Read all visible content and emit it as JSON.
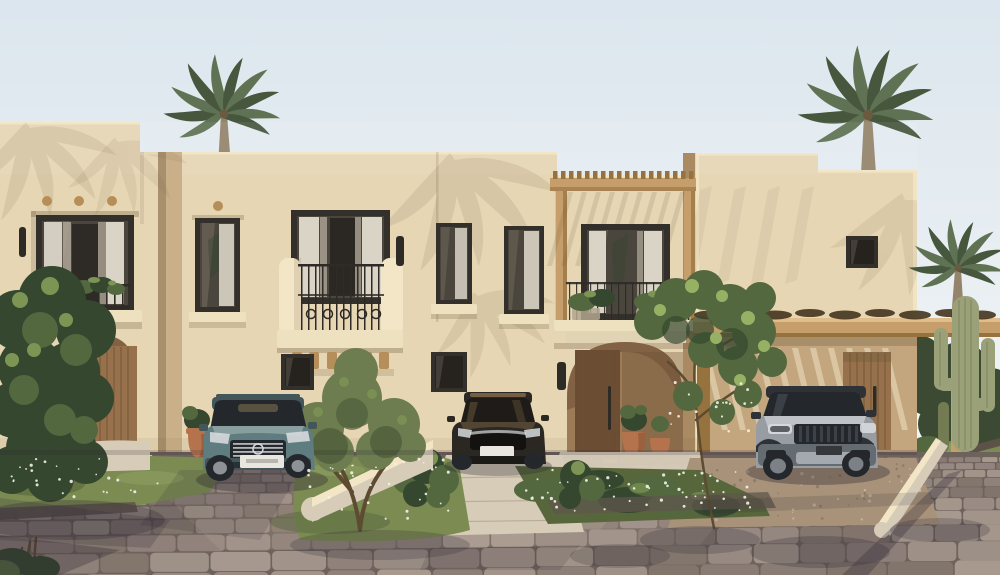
{
  "scene": {
    "description": "Sunny 3D architectural render of a row of sand-colored stucco townhouses with black-framed windows, Juliet balconies, wooden pergolas, arched entrances, palm trees, a saguaro cactus, three parked cars and a cobblestone street in the foreground.",
    "time_of_day": "bright daylight, warm low sun from the left casting palm-frond shadows on the facade",
    "buildings": [
      {
        "name": "townhouse-1",
        "features": [
          "stepped parapet",
          "recessed upper window with Juliet balcony and plants",
          "three round timber dots",
          "two wall sconces",
          "arched entrance alcove with plank wood door",
          "low curved garden wall"
        ]
      },
      {
        "name": "townhouse-2",
        "features": [
          "large upper window with ornamental iron balcony on timber corbels",
          "narrow upper window",
          "two small dark ground-floor windows",
          "wall sconce",
          "driveway with parked sedan"
        ]
      },
      {
        "name": "townhouse-3",
        "features": [
          "timber pergola over balcony with planter boxes",
          "large curtained window",
          "moulded cornice",
          "wide arched entrance with plank door and long handle",
          "terracotta pots with topiary",
          "wall sconce"
        ]
      },
      {
        "name": "townhouse-4",
        "features": [
          "small square window",
          "timber carport pergola with vine-covered beam",
          "slatted light stripes on shaded wall",
          "plank wood side door",
          "parked SUV"
        ]
      }
    ],
    "vehicles": [
      {
        "name": "teal-estate-car",
        "type": "station wagon with roof rails",
        "color": "teal grey",
        "position": "left driveway"
      },
      {
        "name": "dark-sedan",
        "type": "compact sedan",
        "color": "dark bronze black",
        "position": "middle driveway"
      },
      {
        "name": "grey-suv",
        "type": "luxury SUV",
        "color": "silver grey",
        "position": "under right carport"
      }
    ],
    "vegetation": [
      "palm tree behind left parapet",
      "palm tree behind right parapet",
      "small palm at far right",
      "large dark green shrub at far left",
      "olive tree on central grass mound",
      "climbing tree at carport corner",
      "white-flowering ground cover beds",
      "round clipped bushes",
      "saguaro cactus",
      "balcony plants"
    ],
    "street": {
      "surface": "cobblestone setts in tilted rows",
      "extras": [
        "concrete driveway apron",
        "gravel carport drive",
        "stone kerbs",
        "long diagonal post shadow",
        "dappled tree shadows"
      ]
    }
  },
  "palette": {
    "sky_top": "#dce6ee",
    "sky_bottom": "#f7f8f7",
    "wall": "#e6d6b4",
    "wall_light": "#f2e6c6",
    "wall_shade": "#c3a67e",
    "wall_return": "#a98a62",
    "shadow_warm": "#6b5638",
    "shadow_cool": "#2a2432",
    "alcove": "#9c7b57",
    "alcove_dark": "#6d4f35",
    "door_wood": "#96714b",
    "door_wood_dark": "#6b4d33",
    "door_wood_lit": "#b08a5c",
    "frame_dark": "#332f2a",
    "glass": "#4a453d",
    "glass_dark": "#26231f",
    "glass_light": "#7b7264",
    "curtain": "#dad4c7",
    "curtain_shade": "#b4ac9d",
    "iron": "#2e2a26",
    "wood": "#c59e6b",
    "wood_dark": "#96723f",
    "wood_light": "#e0bd8a",
    "vine_dark": "#44351f",
    "ledge": "#eee1bf",
    "corbel": "#b68e5a",
    "branch": "#5d4b32",
    "green_dark": "#35472f",
    "green_mid": "#53683f",
    "green_light": "#7c9454",
    "green_bright": "#97b164",
    "olive": "#6d7d50",
    "olive_dark": "#4f5e3a",
    "palm_green": "#5f7354",
    "palm_dark": "#46573e",
    "palm_trunk": "#94846c",
    "cactus": "#9aa077",
    "cactus_dark": "#737b52",
    "grass": "#7b8b52",
    "grass_light": "#9cab68",
    "grass_shade": "#57673b",
    "flower": "#f3f2e8",
    "terracotta": "#b5734d",
    "terracotta_dark": "#8a5434",
    "concrete": "#d6ccb8",
    "concrete_shade": "#b2a68e",
    "gravel": "#a8937a",
    "gravel_dark": "#7f6d57",
    "street_base": "#6e625c",
    "cobbles": [
      "#9b8d86",
      "#92847d",
      "#a3958c",
      "#8a7c75",
      "#a89a8f",
      "#84776e"
    ],
    "tree_line": "#3c4a34",
    "teal_body": "#5f7c80",
    "teal_dark": "#43575b",
    "teal_light": "#95a9aa",
    "sedan_body": "#2b2824",
    "sedan_warm": "#82694a",
    "sedan_glass": "#1e1b18",
    "suv_body": "#979da3",
    "suv_light": "#c3c8cc",
    "suv_dark": "#646b71",
    "suv_glass": "#24282c",
    "suv_trim": "#2e3236",
    "chrome": "#d7dadc",
    "plate": "#e8e6df",
    "plate_dark": "#34383b"
  }
}
